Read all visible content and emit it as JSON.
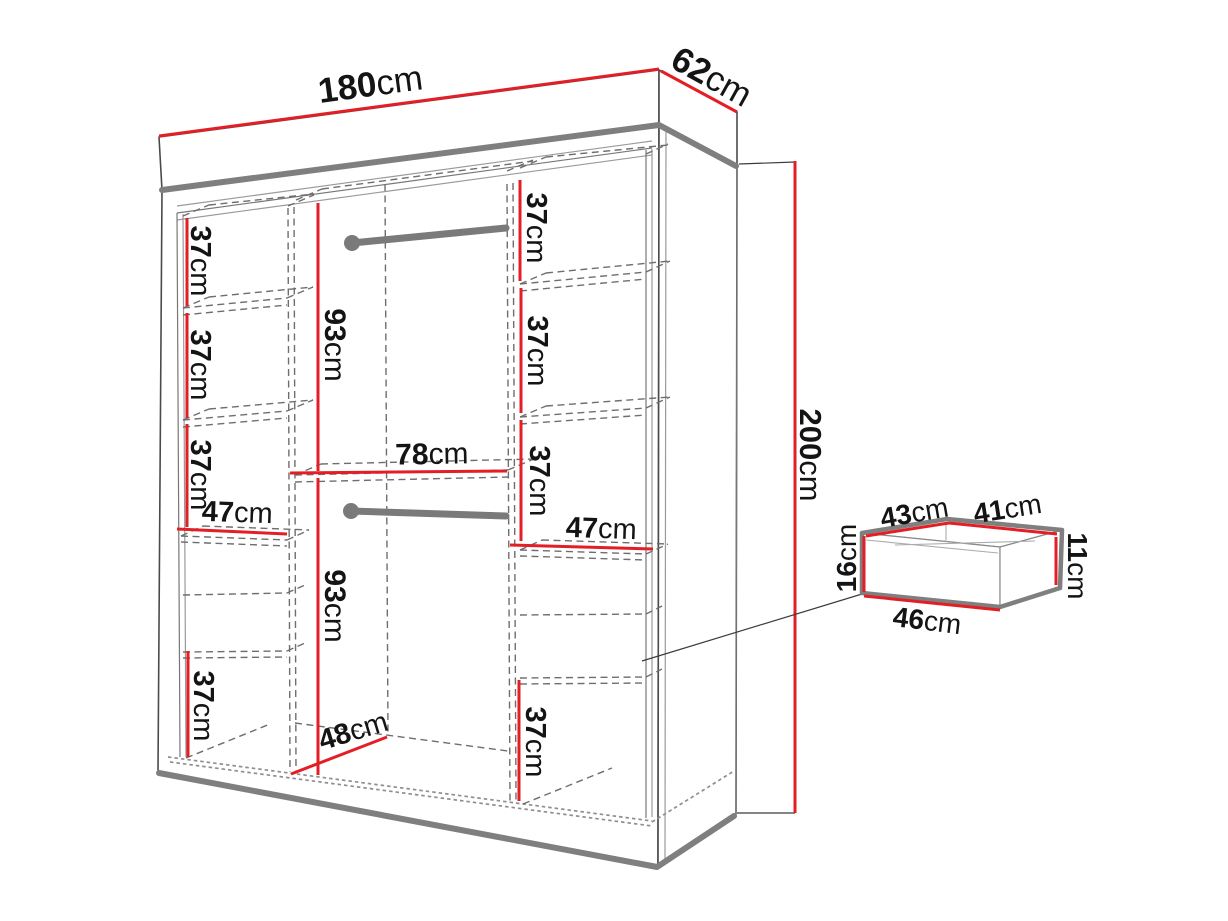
{
  "unit": "cm",
  "colors": {
    "dimension_red": "#e31e24",
    "structure_gray": "#7f7f7f",
    "outline_dark": "#4a4a4a",
    "hidden_gray": "#6e6e6e"
  },
  "wardrobe": {
    "width": "180",
    "depth": "62",
    "height": "200",
    "left_column": {
      "shelf_heights": [
        {
          "value": "37"
        },
        {
          "value": "37"
        },
        {
          "value": "37"
        }
      ],
      "width": "47",
      "bottom_height": "37"
    },
    "middle_column": {
      "top_hanging_height": "93",
      "width": "78",
      "bottom_hanging_height": "93",
      "floor_depth": "48"
    },
    "right_column": {
      "shelf_heights": [
        {
          "value": "37"
        },
        {
          "value": "37"
        },
        {
          "value": "37"
        }
      ],
      "width": "47",
      "bottom_height": "37"
    }
  },
  "drawer_detail": {
    "top_depth": "43",
    "top_width": "41",
    "front_height": "16",
    "back_height": "11",
    "bottom_width": "46"
  }
}
